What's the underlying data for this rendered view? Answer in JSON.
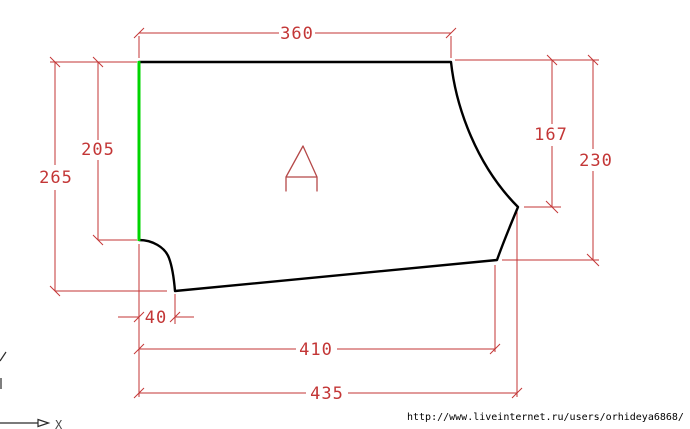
{
  "figure": {
    "part_label": "A",
    "dimensions": {
      "top_width": "360",
      "left_inner_height": "205",
      "left_outer_height": "265",
      "right_inner_height": "167",
      "right_outer_height": "230",
      "notch_width": "40",
      "bottom_inner_width": "410",
      "bottom_outer_width": "435"
    },
    "axis": {
      "x_label": "X"
    },
    "colors": {
      "outline": "#000000",
      "highlight_edge": "#00d400",
      "dimension": "#c33636",
      "part_label": "#b54848"
    }
  },
  "watermark": {
    "url": "http://www.liveinternet.ru/users/orhideya6868/"
  }
}
